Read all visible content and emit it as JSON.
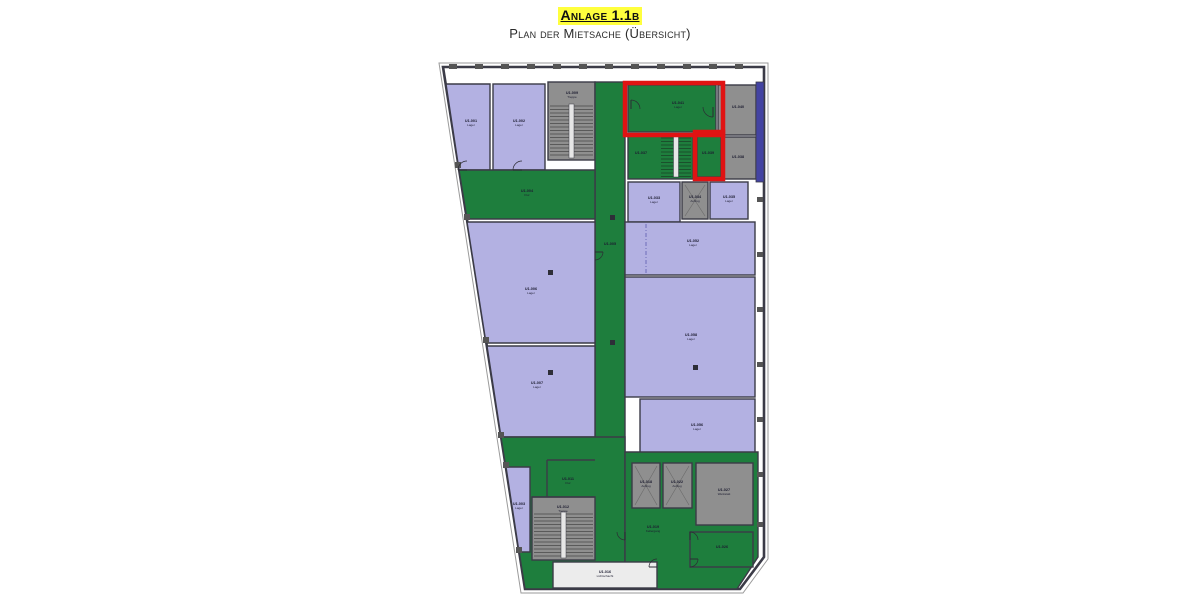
{
  "header": {
    "title": "Anlage 1.1b",
    "subtitle": "Plan der Mietsache (Übersicht)",
    "highlight_color": "#ffff3d"
  },
  "plan": {
    "colors": {
      "purple": "#b3b1e2",
      "green": "#1e7e3d",
      "gray": "#8f8f8f",
      "light": "#ececec",
      "darkblue": "#4343a2",
      "wall": "#3b3b47",
      "red": "#e01313",
      "label": "#1c1c30",
      "tick": "#555555"
    },
    "outline": {
      "outer": "4,1 333,1 333,497 308,531 86,531",
      "inner": "8,5 329,5 329,495 305,527 90,527"
    },
    "darkblue_strip": {
      "x": 321,
      "y": 20,
      "w": 8,
      "h": 100
    },
    "rooms": [
      {
        "id": "u1001",
        "type": "purple",
        "shape": "poly",
        "pts": "11,22 55,22 55,108 24,108",
        "label": "U1.001",
        "sub": "Lager",
        "lx": 36,
        "ly": 60
      },
      {
        "id": "u1002",
        "type": "purple",
        "shape": "rect",
        "x": 58,
        "y": 22,
        "w": 52,
        "h": 86,
        "label": "U1.002",
        "sub": "Lager",
        "lx": 84,
        "ly": 60
      },
      {
        "id": "u1009",
        "type": "gray",
        "shape": "rect",
        "x": 113,
        "y": 20,
        "w": 47,
        "h": 78,
        "label": "U1.009",
        "sub": "Treppe",
        "lx": 137,
        "ly": 32
      },
      {
        "id": "u1005",
        "type": "green",
        "shape": "rect",
        "x": 160,
        "y": 20,
        "w": 30,
        "h": 440,
        "label": "U1.005",
        "sub": "",
        "lx": 175,
        "ly": 183
      },
      {
        "id": "u1004",
        "type": "green",
        "shape": "poly",
        "pts": "24,108 160,108 160,157 32,157",
        "label": "U1.004",
        "sub": "Flur",
        "lx": 92,
        "ly": 130
      },
      {
        "id": "u1006",
        "type": "purple",
        "shape": "poly",
        "pts": "32,160 160,160 160,281 51,281",
        "label": "U1.006",
        "sub": "Lager",
        "lx": 96,
        "ly": 228
      },
      {
        "id": "u1007",
        "type": "purple",
        "shape": "poly",
        "pts": "52,284 160,284 160,375 66,375",
        "label": "U1.007",
        "sub": "Lager",
        "lx": 102,
        "ly": 322
      },
      {
        "id": "u1041",
        "type": "green",
        "shape": "rect",
        "x": 193,
        "y": 23,
        "w": 88,
        "h": 47,
        "label": "U1.041",
        "sub": "Lager",
        "lx": 243,
        "ly": 42
      },
      {
        "id": "u1040",
        "type": "gray",
        "shape": "rect",
        "x": 283,
        "y": 23,
        "w": 38,
        "h": 50,
        "label": "U1.040",
        "sub": "",
        "lx": 303,
        "ly": 46
      },
      {
        "id": "u1038",
        "type": "gray",
        "shape": "rect",
        "x": 283,
        "y": 75,
        "w": 38,
        "h": 42,
        "label": "U1.038",
        "sub": "",
        "lx": 303,
        "ly": 96
      },
      {
        "id": "u1037",
        "type": "green",
        "shape": "rect",
        "x": 193,
        "y": 72,
        "w": 65,
        "h": 45,
        "label": "U1.037",
        "sub": "",
        "lx": 206,
        "ly": 92
      },
      {
        "id": "u1039",
        "type": "green",
        "shape": "rect",
        "x": 262,
        "y": 72,
        "w": 24,
        "h": 43,
        "label": "U1.039",
        "sub": "",
        "lx": 273,
        "ly": 92
      },
      {
        "id": "u1033",
        "type": "purple",
        "shape": "rect",
        "x": 193,
        "y": 120,
        "w": 52,
        "h": 40,
        "label": "U1.033",
        "sub": "Lager",
        "lx": 219,
        "ly": 137
      },
      {
        "id": "u1034",
        "type": "gray",
        "shape": "rect",
        "x": 247,
        "y": 120,
        "w": 26,
        "h": 37,
        "elevator": true,
        "label": "U1.034",
        "sub": "Aufzug",
        "lx": 260,
        "ly": 136
      },
      {
        "id": "u1035",
        "type": "purple",
        "shape": "rect",
        "x": 275,
        "y": 120,
        "w": 38,
        "h": 37,
        "label": "U1.035",
        "sub": "Lager",
        "lx": 294,
        "ly": 136
      },
      {
        "id": "u1052",
        "type": "purple",
        "shape": "rect",
        "x": 190,
        "y": 160,
        "w": 130,
        "h": 53,
        "label": "U1.052",
        "sub": "Lager",
        "lx": 258,
        "ly": 180
      },
      {
        "id": "u1058",
        "type": "purple",
        "shape": "rect",
        "x": 190,
        "y": 215,
        "w": 130,
        "h": 120,
        "label": "U1.058",
        "sub": "Lager",
        "lx": 256,
        "ly": 274
      },
      {
        "id": "u1056",
        "type": "purple",
        "shape": "rect",
        "x": 205,
        "y": 337,
        "w": 115,
        "h": 60,
        "label": "U1.056",
        "sub": "Lager",
        "lx": 262,
        "ly": 364
      },
      {
        "id": "greenBL",
        "type": "green",
        "shape": "poly",
        "pts": "66,375 190,375 190,527 90,527",
        "label": "",
        "sub": ""
      },
      {
        "id": "u1019",
        "type": "green",
        "shape": "poly",
        "pts": "190,390 323,390 323,495 302,527 190,527",
        "label": "U1.019",
        "sub": "Kellergang",
        "lx": 218,
        "ly": 466
      },
      {
        "id": "u1011",
        "type": "none",
        "label": "U1.011",
        "sub": "Flur",
        "lx": 133,
        "ly": 418
      },
      {
        "id": "u1003",
        "type": "purple",
        "shape": "poly",
        "pts": "71,405 95,405 95,490 84,490",
        "label": "U1.003",
        "sub": "Lager",
        "lx": 84,
        "ly": 443
      },
      {
        "id": "u1012",
        "type": "gray",
        "shape": "rect",
        "x": 97,
        "y": 435,
        "w": 63,
        "h": 63,
        "label": "U1.012",
        "sub": "Treppe",
        "lx": 128,
        "ly": 446
      },
      {
        "id": "u1016",
        "type": "light",
        "shape": "rect",
        "x": 118,
        "y": 500,
        "w": 104,
        "h": 26,
        "label": "U1.016",
        "sub": "Lichtschacht",
        "lx": 170,
        "ly": 511
      },
      {
        "id": "u1018",
        "type": "gray",
        "shape": "rect",
        "x": 197,
        "y": 401,
        "w": 28,
        "h": 45,
        "elevator": true,
        "label": "U1.018",
        "sub": "Aufzug",
        "lx": 211,
        "ly": 421
      },
      {
        "id": "u1022",
        "type": "gray",
        "shape": "rect",
        "x": 228,
        "y": 401,
        "w": 29,
        "h": 45,
        "elevator": true,
        "label": "U1.022",
        "sub": "Aufzug",
        "lx": 242,
        "ly": 421
      },
      {
        "id": "u1027",
        "type": "gray",
        "shape": "rect",
        "x": 261,
        "y": 401,
        "w": 57,
        "h": 62,
        "label": "U1.027",
        "sub": "Werkstatt",
        "lx": 289,
        "ly": 429
      },
      {
        "id": "u1026",
        "type": "green",
        "shape": "rect",
        "x": 255,
        "y": 470,
        "w": 63,
        "h": 35,
        "label": "U1.026",
        "sub": "",
        "lx": 287,
        "ly": 486
      }
    ],
    "stairs": [
      {
        "x": 115,
        "y": 42,
        "w": 43,
        "h": 54
      },
      {
        "x": 226,
        "y": 74,
        "w": 30,
        "h": 41
      },
      {
        "x": 99,
        "y": 450,
        "w": 59,
        "h": 46
      }
    ],
    "walls": [
      {
        "x1": 112,
        "y1": 398,
        "x2": 160,
        "y2": 398
      },
      {
        "x1": 112,
        "y1": 398,
        "x2": 112,
        "y2": 435
      },
      {
        "x1": 97,
        "y1": 435,
        "x2": 160,
        "y2": 435
      }
    ],
    "dash_lines": [
      {
        "x1": 211,
        "y1": 162,
        "x2": 211,
        "y2": 211
      }
    ],
    "columns": [
      {
        "x": 113,
        "y": 208
      },
      {
        "x": 113,
        "y": 308
      },
      {
        "x": 258,
        "y": 303
      },
      {
        "x": 175,
        "y": 153
      },
      {
        "x": 175,
        "y": 278
      }
    ],
    "doors": [
      {
        "cx": 32,
        "cy": 108,
        "r": 9,
        "a1": 180,
        "a2": 270
      },
      {
        "cx": 87,
        "cy": 108,
        "r": 9,
        "a1": 180,
        "a2": 270
      },
      {
        "cx": 196,
        "cy": 47,
        "r": 9,
        "a1": 270,
        "a2": 360
      },
      {
        "cx": 278,
        "cy": 45,
        "r": 10,
        "a1": 90,
        "a2": 180
      },
      {
        "cx": 160,
        "cy": 190,
        "r": 8,
        "a1": 0,
        "a2": 90
      },
      {
        "cx": 255,
        "cy": 478,
        "r": 8,
        "a1": 270,
        "a2": 360
      },
      {
        "cx": 255,
        "cy": 497,
        "r": 8,
        "a1": 0,
        "a2": 90
      },
      {
        "cx": 222,
        "cy": 505,
        "r": 8,
        "a1": 180,
        "a2": 270
      },
      {
        "cx": 190,
        "cy": 470,
        "r": 8,
        "a1": 90,
        "a2": 180
      }
    ],
    "red_boxes": [
      {
        "x": 190,
        "y": 21,
        "w": 98,
        "h": 52
      },
      {
        "x": 260,
        "y": 70,
        "w": 28,
        "h": 47
      }
    ],
    "ticks_top_y": 2,
    "ticks_top_x": [
      14,
      40,
      66,
      92,
      118,
      144,
      170,
      196,
      222,
      248,
      274,
      300
    ],
    "ticks_right_x": 322,
    "ticks_right_y": [
      135,
      190,
      245,
      300,
      355,
      410,
      460
    ],
    "ticks_slant": [
      {
        "x": 20,
        "y": 100
      },
      {
        "x": 29,
        "y": 152
      },
      {
        "x": 48,
        "y": 275
      },
      {
        "x": 63,
        "y": 370
      },
      {
        "x": 68,
        "y": 400
      },
      {
        "x": 81,
        "y": 485
      }
    ]
  }
}
